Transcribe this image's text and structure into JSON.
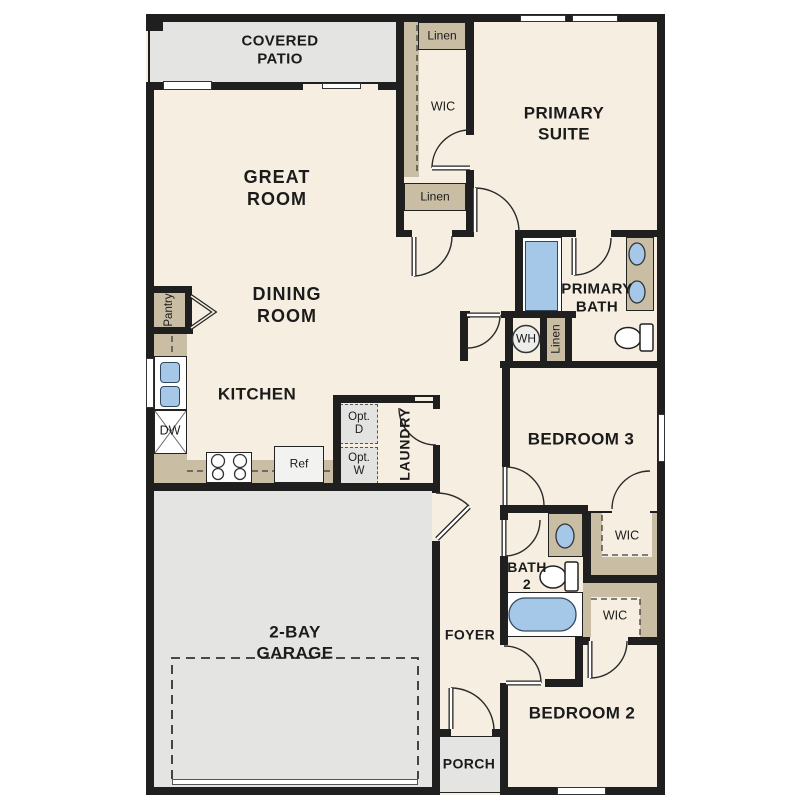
{
  "labels": {
    "covered_patio": "COVERED\nPATIO",
    "great_room": "GREAT\nROOM",
    "dining_room": "DINING\nROOM",
    "kitchen": "KITCHEN",
    "primary_suite": "PRIMARY\nSUITE",
    "primary_bath": "PRIMARY\nBATH",
    "bedroom_3": "BEDROOM 3",
    "bedroom_2": "BEDROOM 2",
    "bath_2": "BATH\n2",
    "foyer": "FOYER",
    "porch": "PORCH",
    "garage": "2-BAY\nGARAGE",
    "laundry": "LAUNDRY",
    "pantry": "Pantry",
    "wic_primary": "WIC",
    "wic_bedroom3": "WIC",
    "wic_bedroom2": "WIC",
    "linen_closet_top": "Linen",
    "linen_hall": "Linen",
    "linen_bath": "Linen",
    "water_heater": "WH",
    "dishwasher": "DW",
    "refrigerator": "Ref",
    "optional_dryer": "Opt.\nD",
    "optional_washer": "Opt.\nW"
  },
  "colors": {
    "wall": "#1f1f1f",
    "floor": "#f6efe1",
    "closet_tan": "#c9bda4",
    "fixture_blue": "#a6c8e8",
    "exterior_gray": "#e4e4e2"
  }
}
